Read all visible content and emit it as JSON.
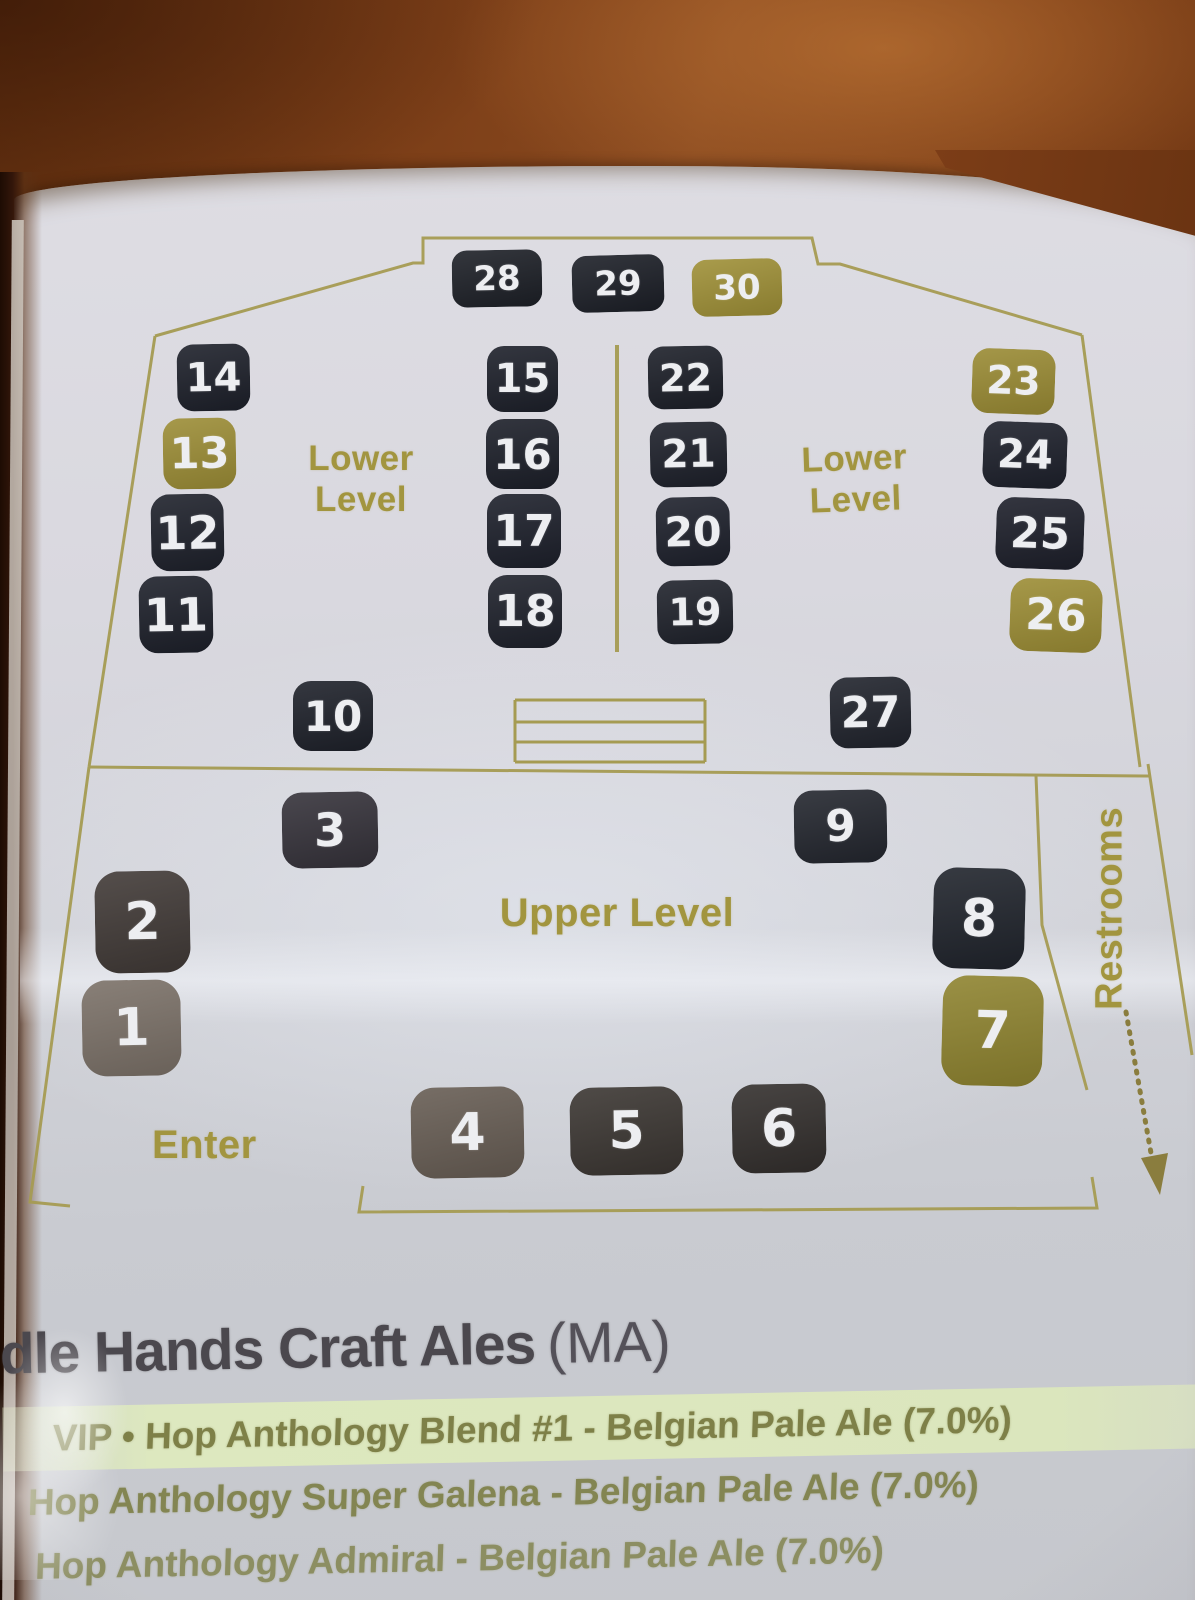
{
  "colors": {
    "outline_gold": "#a59b52",
    "label_gold": "#a2953f",
    "booth_dark": "#1d202a",
    "booth_gold": "#9c8d36",
    "booth_taupe": "#7b7168",
    "booth_brown": "#413a37",
    "heading_text": "#4b484e",
    "beer_text": "#7e8048",
    "beer_highlight": "#dde8bf",
    "paper": "#d5d5db",
    "wood": "#7d3f18"
  },
  "map": {
    "lower_left_label": "Lower Level",
    "lower_right_label": "Lower Level",
    "upper_label": "Upper Level",
    "enter_label": "Enter",
    "restrooms_label": "Restrooms",
    "booths": [
      {
        "num": "28",
        "x": 452,
        "y": 250,
        "w": 90,
        "h": 57,
        "bg": "#1d2027",
        "r": -1
      },
      {
        "num": "29",
        "x": 572,
        "y": 255,
        "w": 92,
        "h": 57,
        "bg": "#1c1f27",
        "r": -1.5
      },
      {
        "num": "30",
        "x": 692,
        "y": 259,
        "w": 90,
        "h": 57,
        "bg": "#9f9037",
        "r": -1.5
      },
      {
        "num": "14",
        "x": 177,
        "y": 344,
        "w": 73,
        "h": 67,
        "bg": "#1d202a",
        "r": -1
      },
      {
        "num": "13",
        "x": 163,
        "y": 418,
        "w": 73,
        "h": 71,
        "bg": "#9c8d36",
        "r": -1
      },
      {
        "num": "12",
        "x": 151,
        "y": 494,
        "w": 73,
        "h": 77,
        "bg": "#1e212b",
        "r": -1
      },
      {
        "num": "11",
        "x": 139,
        "y": 576,
        "w": 74,
        "h": 77,
        "bg": "#1d202a",
        "r": -1
      },
      {
        "num": "15",
        "x": 487,
        "y": 346,
        "w": 71,
        "h": 66,
        "bg": "#1d202a",
        "r": 0
      },
      {
        "num": "16",
        "x": 486,
        "y": 419,
        "w": 73,
        "h": 70,
        "bg": "#1c1f29",
        "r": 0
      },
      {
        "num": "17",
        "x": 487,
        "y": 494,
        "w": 74,
        "h": 74,
        "bg": "#1d202b",
        "r": 0
      },
      {
        "num": "18",
        "x": 488,
        "y": 575,
        "w": 74,
        "h": 73,
        "bg": "#1e212b",
        "r": 0
      },
      {
        "num": "22",
        "x": 648,
        "y": 346,
        "w": 75,
        "h": 63,
        "bg": "#1c1f28",
        "r": -1
      },
      {
        "num": "21",
        "x": 650,
        "y": 422,
        "w": 77,
        "h": 65,
        "bg": "#1d202a",
        "r": -1
      },
      {
        "num": "20",
        "x": 656,
        "y": 497,
        "w": 74,
        "h": 69,
        "bg": "#1e212c",
        "r": -1
      },
      {
        "num": "19",
        "x": 657,
        "y": 580,
        "w": 76,
        "h": 64,
        "bg": "#1f222b",
        "r": -1
      },
      {
        "num": "23",
        "x": 972,
        "y": 349,
        "w": 83,
        "h": 65,
        "bg": "#9a8b34",
        "r": 2
      },
      {
        "num": "24",
        "x": 983,
        "y": 422,
        "w": 84,
        "h": 66,
        "bg": "#1d202b",
        "r": 2
      },
      {
        "num": "25",
        "x": 996,
        "y": 498,
        "w": 88,
        "h": 71,
        "bg": "#1d1f2a",
        "r": 2
      },
      {
        "num": "26",
        "x": 1010,
        "y": 579,
        "w": 92,
        "h": 73,
        "bg": "#9c8d35",
        "r": 2
      },
      {
        "num": "10",
        "x": 293,
        "y": 681,
        "w": 80,
        "h": 70,
        "bg": "#1e212a",
        "r": 0
      },
      {
        "num": "27",
        "x": 830,
        "y": 677,
        "w": 81,
        "h": 71,
        "bg": "#20232c",
        "r": -1
      },
      {
        "num": "3",
        "x": 282,
        "y": 792,
        "w": 96,
        "h": 76,
        "bg": "#35323a",
        "r": -1
      },
      {
        "num": "9",
        "x": 794,
        "y": 790,
        "w": 93,
        "h": 73,
        "bg": "#23262e",
        "r": -1
      },
      {
        "num": "2",
        "x": 95,
        "y": 871,
        "w": 95,
        "h": 102,
        "bg": "#413a37",
        "r": -1
      },
      {
        "num": "8",
        "x": 933,
        "y": 868,
        "w": 92,
        "h": 101,
        "bg": "#20242c",
        "r": 1.5
      },
      {
        "num": "1",
        "x": 82,
        "y": 980,
        "w": 99,
        "h": 96,
        "bg": "#7b7168",
        "r": -1
      },
      {
        "num": "7",
        "x": 942,
        "y": 976,
        "w": 101,
        "h": 110,
        "bg": "#8f8430",
        "r": 1.5
      },
      {
        "num": "4",
        "x": 411,
        "y": 1087,
        "w": 113,
        "h": 91,
        "bg": "#675d54",
        "r": -1
      },
      {
        "num": "5",
        "x": 570,
        "y": 1087,
        "w": 113,
        "h": 88,
        "bg": "#3b3632",
        "r": -1
      },
      {
        "num": "6",
        "x": 732,
        "y": 1084,
        "w": 94,
        "h": 89,
        "bg": "#332f2d",
        "r": -1
      }
    ]
  },
  "brewery": {
    "name": "Idle Hands Craft Ales",
    "region": "(MA)",
    "beers": [
      {
        "text": "VIP • Hop Anthology Blend #1 - Belgian Pale Ale (7.0%)",
        "highlighted": true
      },
      {
        "text": "Hop Anthology Super Galena - Belgian Pale Ale (7.0%)",
        "highlighted": false
      },
      {
        "text": "Hop Anthology Admiral - Belgian Pale Ale (7.0%)",
        "highlighted": false
      }
    ]
  }
}
